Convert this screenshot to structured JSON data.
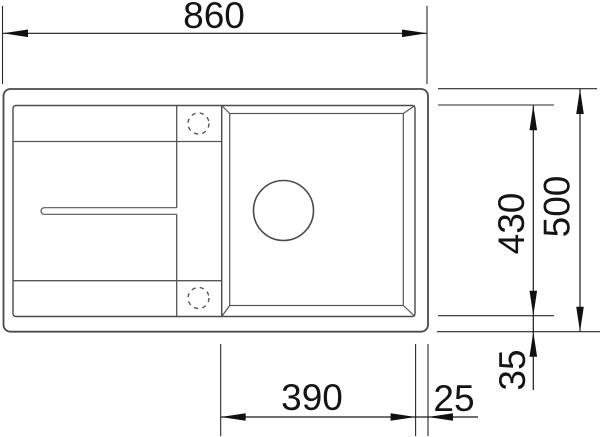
{
  "drawing": {
    "type": "sink-installation-top-view",
    "dimensions": {
      "overall_width": "860",
      "overall_depth": "500",
      "bowl_depth": "430",
      "bowl_width": "390",
      "right_rim_offset": "25",
      "bottom_rim_offset": "35"
    },
    "colors": {
      "background": "#ffffff",
      "outline": "#4a4a4a",
      "dimension": "#1a1a1a"
    }
  }
}
